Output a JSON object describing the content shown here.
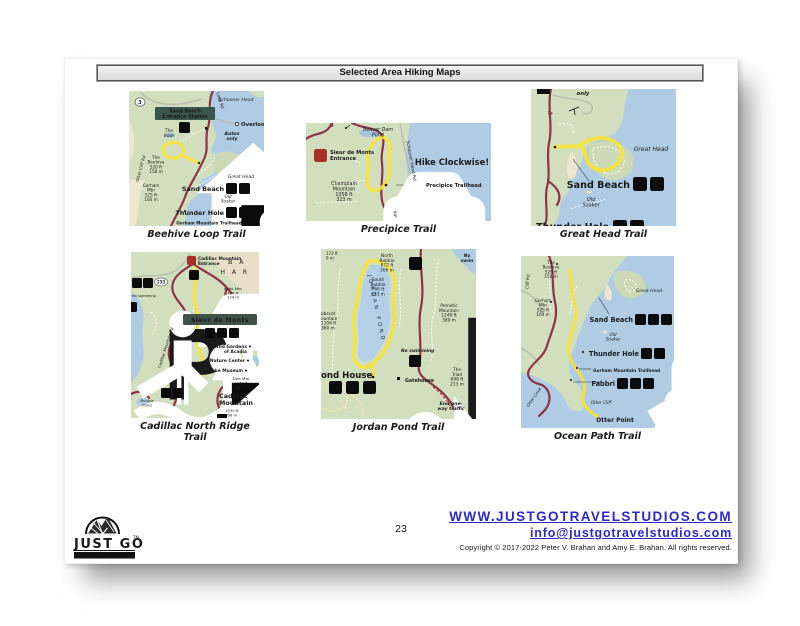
{
  "page": {
    "title": "Selected Area Hiking Maps",
    "page_number": "23"
  },
  "footer": {
    "website": "WWW.JUSTGOTRAVELSTUDIOS.COM",
    "email": "info@justgotravelstudios.com",
    "copyright": "Copyright © 2017-2022 Peter V. Brahan and Amy E. Brahan.  All rights reserved.",
    "logo": {
      "name": "JUST GO",
      "sub": "TRAVEL STUDIOS",
      "tm": "TM"
    }
  },
  "palette": {
    "water": "#b0cce4",
    "land": "#d2dfbe",
    "sand": "#efe6d0",
    "road": "#8e3448",
    "road_minor": "#b9b9af",
    "trail_highlight": "#f6e339",
    "banner": "#3f5148",
    "red_label": "#a83028",
    "blue_label": "#4a7ab0",
    "link": "#2a2ac8"
  },
  "maps": {
    "beehive": {
      "caption": "Beehive Loop Trail",
      "labels": {
        "route": "3",
        "schooner_head": "Schooner Head",
        "station": "Sand Beach\nEntrance Station",
        "overlook": "Overlook",
        "autos_only": "Autos\nonly",
        "the_bowl": "The\nBowl",
        "beehive": "The\nBeehive\n520 ft\n158 m",
        "otter_cliff_rd": "Otter Cliff Rd",
        "loop_rd": "Loop Rd",
        "gorham": "Gorham\nMtn\n525 ft\n160 m",
        "great_head": "Great Head",
        "sand_beach": "Sand Beach",
        "old_soaker": "Old\nSoaker",
        "thunder_hole": "Thunder Hole",
        "trailhead": "Gorham Mountain Trailhead"
      }
    },
    "precipice": {
      "caption": "Precipice Trail",
      "labels": {
        "beaver_dam": "Beaver Dam\nPond",
        "entrance": "Sieur de Monts\nEntrance",
        "hike": "Hike Clockwise!",
        "champlain": "Champlain\nMountain\n1058 ft\n323 m",
        "trailhead": "Precipice Trailhead",
        "schooner_rd": "Schooner Head Rd",
        "park": "Par"
      }
    },
    "great_head": {
      "caption": "Great Head Trail",
      "labels": {
        "only": "only",
        "great_head": "Great Head",
        "sand_beach": "Sand Beach",
        "old_soaker": "Old\nSoaker",
        "thunder_hole": "Thunder Hole"
      }
    },
    "cadillac": {
      "caption": "Cadillac North Ridge Trail",
      "labels": {
        "entrance": "Cadillac Mountain\nEntrance",
        "bar": "B A",
        "har": "H A R",
        "route": "233",
        "kebo": "Kebo Mtn\n407 ft\n124 m",
        "sieur": "Sieur de Monts",
        "wild_gardens": "Wild Gardens\nof Acadia",
        "nature_center": "Nature Center",
        "abbe": "Abbe Museum",
        "dorr": "Dorr Mtn\n1270 ft\n387 m",
        "cadillac": "Cadillac\nMountain",
        "cadillac_elev": "1530 ft\n466 m",
        "cadillac_rd": "Cadillac Mountain Rd",
        "bubble_pond": "Bubble\nPond",
        "no_swimming": "No swimming"
      }
    },
    "jordan": {
      "caption": "Jordan Pond Trail",
      "labels": {
        "elev_cut": "173 ft\n9 m",
        "north_bubble": "North\nBubble\n872 ft\n266 m",
        "south_bubble": "South\nBubble\n766 ft\n233 m",
        "pond": "JORDAN POND",
        "pemetic": "Pemetic\nMountain\n1248 ft\n380 m",
        "penobscot": "obscot\nountain\n1194 ft\n360 m",
        "no_swim_top": "No\nswim",
        "no_swimming": "No swimming",
        "pond_house": "ond House",
        "gatehouse": "Gatehouse",
        "triad": "The\nTriad\n698 ft\n213 m",
        "end_one_way": "End  one-\nway traffic"
      }
    },
    "ocean": {
      "caption": "Ocean Path Trail",
      "labels": {
        "beehive": "The\nBeehive\n520 ft\n158 m",
        "gorham": "Gorham\nMtn\n525 ft\n160 m",
        "cliff_rd": "Cliff Rd",
        "great_head": "Great Head",
        "sand_beach": "Sand Beach",
        "old_soaker": "Old\nSoaker",
        "thunder_hole": "Thunder Hole",
        "trailhead": "Gorham Mountain Trailhead",
        "fabbri": "Fabbri",
        "otter_cliff": "Otter Cliff",
        "otter_point": "Otter Point",
        "otter_cove": "Otter Cove"
      }
    }
  }
}
